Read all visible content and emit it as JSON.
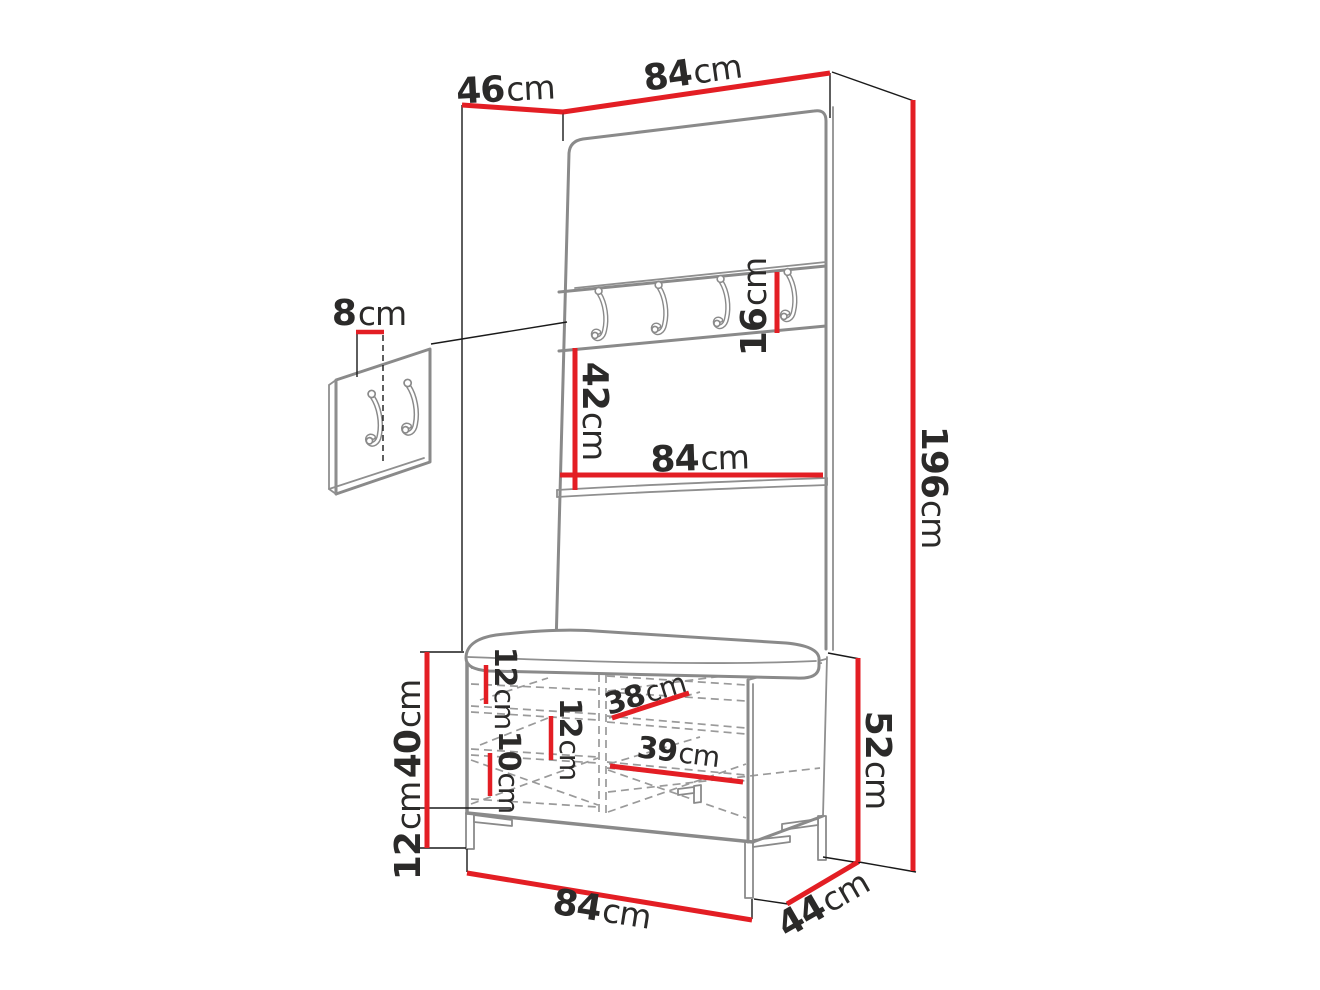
{
  "figure": {
    "type": "furniture-dimension-diagram",
    "subject": "hallway set: wall panel with coat hooks, shelf and shoe bench with cushion",
    "colors": {
      "dimension_line": "#e31e24",
      "structure_line": "#8a8a8a",
      "label_text": "#2b2a29",
      "background": "#ffffff"
    },
    "dimensions": {
      "side_depth_top": {
        "value": "46",
        "unit": "cm"
      },
      "width_top": {
        "value": "84",
        "unit": "cm"
      },
      "total_height": {
        "value": "196",
        "unit": "cm"
      },
      "hook_rail_height": {
        "value": "16",
        "unit": "cm"
      },
      "rail_to_shelf_gap": {
        "value": "42",
        "unit": "cm"
      },
      "panel_width": {
        "value": "84",
        "unit": "cm"
      },
      "hook_offset": {
        "value": "8",
        "unit": "cm"
      },
      "bench_body_height": {
        "value": "40",
        "unit": "cm"
      },
      "leg_height": {
        "value": "12",
        "unit": "cm"
      },
      "bench_top_gap": {
        "value": "12",
        "unit": "cm"
      },
      "bench_middle_gap": {
        "value": "12",
        "unit": "cm"
      },
      "bench_lower_gap": {
        "value": "10",
        "unit": "cm"
      },
      "compartment_depth": {
        "value": "38",
        "unit": "cm"
      },
      "compartment_width": {
        "value": "39",
        "unit": "cm"
      },
      "bench_total_height": {
        "value": "52",
        "unit": "cm"
      },
      "bench_width": {
        "value": "84",
        "unit": "cm"
      },
      "bench_depth": {
        "value": "44",
        "unit": "cm"
      }
    }
  }
}
